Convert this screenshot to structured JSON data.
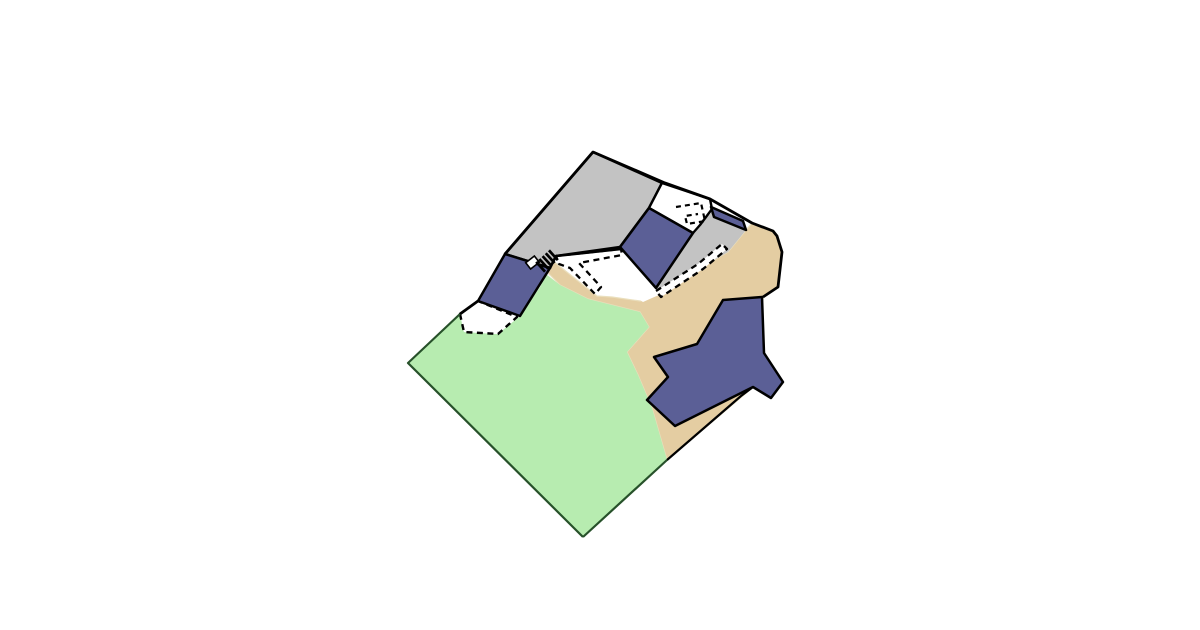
{
  "canvas": {
    "width": 1200,
    "height": 630,
    "background": "#ffffff"
  },
  "palette": {
    "paved_gray": "#c3c3c3",
    "building_blue": "#5b5f96",
    "sand_tan": "#e4cda2",
    "sand_edge": "#eadfbd",
    "grass_green": "#b7ecb0",
    "grass_edge": "#27512a",
    "outline_black": "#000000",
    "white": "#ffffff"
  },
  "map": {
    "kind": "cadastral-parcel-land-use-plan",
    "layers": [
      {
        "name": "sand-area",
        "type": "polygon",
        "fill": "#e4cda2",
        "stroke": "#eadfbd",
        "strokeWidth": 1.2,
        "points": [
          [
            548,
            257
          ],
          [
            543,
            268
          ],
          [
            560,
            285
          ],
          [
            588,
            299
          ],
          [
            640,
            312
          ],
          [
            649,
            327
          ],
          [
            627,
            352
          ],
          [
            638,
            375
          ],
          [
            652,
            408
          ],
          [
            667,
            460
          ],
          [
            745,
            394
          ],
          [
            753,
            387
          ],
          [
            763,
            297
          ],
          [
            778,
            287
          ],
          [
            782,
            252
          ],
          [
            777,
            236
          ],
          [
            773,
            231
          ],
          [
            752,
            223
          ],
          [
            746,
            230
          ],
          [
            728,
            252
          ],
          [
            700,
            268
          ],
          [
            658,
            295
          ],
          [
            640,
            301
          ],
          [
            612,
            297
          ],
          [
            597,
            296
          ]
        ]
      },
      {
        "name": "grass-area",
        "type": "polygon",
        "fill": "#b7ecb0",
        "stroke": "none",
        "strokeWidth": 0,
        "points": [
          [
            408,
            363
          ],
          [
            460,
            314
          ],
          [
            464,
            332
          ],
          [
            498,
            334
          ],
          [
            520,
            316
          ],
          [
            540,
            287
          ],
          [
            546,
            274
          ],
          [
            560,
            285
          ],
          [
            588,
            299
          ],
          [
            640,
            312
          ],
          [
            649,
            327
          ],
          [
            627,
            352
          ],
          [
            638,
            375
          ],
          [
            652,
            408
          ],
          [
            667,
            460
          ],
          [
            583,
            537
          ]
        ]
      },
      {
        "name": "paved-area-main",
        "type": "polygon",
        "fill": "#c3c3c3",
        "stroke": "#000000",
        "strokeWidth": 2.6,
        "points": [
          [
            593,
            152
          ],
          [
            662,
            183
          ],
          [
            649,
            208
          ],
          [
            620,
            247
          ],
          [
            556,
            256
          ],
          [
            550,
            268
          ],
          [
            505,
            254
          ]
        ]
      },
      {
        "name": "paved-area-east",
        "type": "polygon",
        "fill": "#c3c3c3",
        "stroke": "none",
        "strokeWidth": 0,
        "points": [
          [
            693,
            233
          ],
          [
            700,
            225
          ],
          [
            712,
            212
          ],
          [
            714,
            217
          ],
          [
            746,
            230
          ],
          [
            728,
            252
          ],
          [
            700,
            268
          ],
          [
            658,
            294
          ],
          [
            656,
            288
          ]
        ]
      },
      {
        "name": "open-yard-north",
        "type": "polygon",
        "fill": "#ffffff",
        "stroke": "#000000",
        "strokeWidth": 2.4,
        "points": [
          [
            662,
            183
          ],
          [
            710,
            199
          ],
          [
            712,
            209
          ],
          [
            700,
            225
          ],
          [
            693,
            233
          ],
          [
            649,
            208
          ]
        ]
      },
      {
        "name": "white-gap-center",
        "type": "polygon",
        "fill": "#ffffff",
        "stroke": "none",
        "strokeWidth": 0,
        "points": [
          [
            635,
            297
          ],
          [
            656,
            288
          ],
          [
            661,
            294
          ],
          [
            643,
            302
          ]
        ]
      },
      {
        "name": "unfenced-yard-west",
        "type": "polygon",
        "fill": "#ffffff",
        "stroke": "#000000",
        "strokeWidth": 2.4,
        "dash": "6 4.5",
        "points": [
          [
            460,
            314
          ],
          [
            478,
            301
          ],
          [
            517,
            317
          ],
          [
            498,
            334
          ],
          [
            464,
            332
          ]
        ]
      },
      {
        "name": "walkway-west",
        "type": "polygon",
        "fill": "#ffffff",
        "stroke": "#000000",
        "strokeWidth": 2.3,
        "dash": "6 4.5",
        "points": [
          [
            556,
            256
          ],
          [
            621,
            249
          ],
          [
            622,
            255
          ],
          [
            579,
            263
          ],
          [
            601,
            287
          ],
          [
            595,
            294
          ],
          [
            570,
            268
          ],
          [
            559,
            264
          ]
        ]
      },
      {
        "name": "walkway-west-top-edge",
        "type": "polyline",
        "stroke": "#000000",
        "strokeWidth": 2.6,
        "points": [
          [
            556,
            256
          ],
          [
            621,
            249
          ]
        ]
      },
      {
        "name": "walkway-east",
        "type": "polygon",
        "fill": "#ffffff",
        "stroke": "#000000",
        "strokeWidth": 2.3,
        "dash": "6 4.5",
        "points": [
          [
            656,
            291
          ],
          [
            698,
            264
          ],
          [
            722,
            244
          ],
          [
            727,
            249
          ],
          [
            703,
            269
          ],
          [
            661,
            297
          ]
        ]
      },
      {
        "name": "overhang-outline-north",
        "type": "polyline",
        "stroke": "#000000",
        "strokeWidth": 2.2,
        "dash": "5 4",
        "points": [
          [
            676,
            207
          ],
          [
            701,
            203
          ],
          [
            705,
            221
          ],
          [
            687,
            224
          ],
          [
            685,
            216
          ],
          [
            698,
            214
          ]
        ]
      },
      {
        "name": "building-central",
        "type": "polygon",
        "fill": "#5b5f96",
        "stroke": "#000000",
        "strokeWidth": 2.5,
        "points": [
          [
            649,
            208
          ],
          [
            693,
            233
          ],
          [
            656,
            288
          ],
          [
            620,
            247
          ]
        ]
      },
      {
        "name": "building-northeast",
        "type": "polygon",
        "fill": "#5b5f96",
        "stroke": "#000000",
        "strokeWidth": 2.5,
        "points": [
          [
            711,
            207
          ],
          [
            743,
            221
          ],
          [
            746,
            230
          ],
          [
            714,
            217
          ]
        ]
      },
      {
        "name": "building-west",
        "type": "polygon",
        "fill": "#5b5f96",
        "stroke": "#000000",
        "strokeWidth": 2.5,
        "points": [
          [
            505,
            254
          ],
          [
            550,
            268
          ],
          [
            520,
            316
          ],
          [
            478,
            301
          ]
        ]
      },
      {
        "name": "building-cross-southeast",
        "type": "polygon",
        "fill": "#5b5f96",
        "stroke": "#000000",
        "strokeWidth": 2.5,
        "points": [
          [
            723,
            300
          ],
          [
            762,
            297
          ],
          [
            764,
            353
          ],
          [
            783,
            382
          ],
          [
            771,
            398
          ],
          [
            753,
            387
          ],
          [
            675,
            426
          ],
          [
            647,
            400
          ],
          [
            668,
            377
          ],
          [
            654,
            357
          ],
          [
            697,
            344
          ]
        ]
      },
      {
        "name": "parcel-boundary-northeast",
        "type": "polyline",
        "stroke": "#000000",
        "strokeWidth": 2.8,
        "points": [
          [
            593,
            152
          ],
          [
            665,
            183
          ],
          [
            710,
            199
          ],
          [
            752,
            223
          ],
          [
            773,
            231
          ],
          [
            777,
            236
          ],
          [
            782,
            252
          ],
          [
            778,
            287
          ],
          [
            763,
            297
          ]
        ]
      },
      {
        "name": "parcel-boundary-northwest",
        "type": "polyline",
        "stroke": "#000000",
        "strokeWidth": 2.8,
        "points": [
          [
            593,
            152
          ],
          [
            505,
            254
          ]
        ]
      },
      {
        "name": "parcel-boundary-west-notch",
        "type": "polyline",
        "stroke": "#000000",
        "strokeWidth": 2.8,
        "points": [
          [
            478,
            301
          ],
          [
            460,
            314
          ]
        ]
      },
      {
        "name": "parcel-boundary-southeast-upper",
        "type": "polyline",
        "stroke": "#000000",
        "strokeWidth": 2.2,
        "points": [
          [
            753,
            387
          ],
          [
            741,
            396
          ],
          [
            667,
            460
          ]
        ]
      },
      {
        "name": "parcel-boundary-southeast-lower",
        "type": "polyline",
        "stroke": "#27512a",
        "strokeWidth": 2.2,
        "points": [
          [
            667,
            460
          ],
          [
            583,
            537
          ]
        ]
      },
      {
        "name": "parcel-boundary-southwest",
        "type": "polyline",
        "stroke": "#27512a",
        "strokeWidth": 2.2,
        "points": [
          [
            460,
            314
          ],
          [
            408,
            363
          ],
          [
            583,
            537
          ]
        ]
      }
    ],
    "stairs_icon": {
      "name": "stairs-icon",
      "cx": 547,
      "cy": 261,
      "angle": -42,
      "bars": 5,
      "spacing": 4.3,
      "halfLength": 6.6,
      "strokeWidth": 2.7,
      "color": "#000000"
    },
    "entrance_marker": {
      "name": "entrance-marker",
      "cx": 532.5,
      "cy": 262.5,
      "width": 11,
      "height": 8,
      "angle": -38,
      "fill": "#ffffff",
      "stroke": "#000000",
      "strokeWidth": 1.6
    }
  }
}
